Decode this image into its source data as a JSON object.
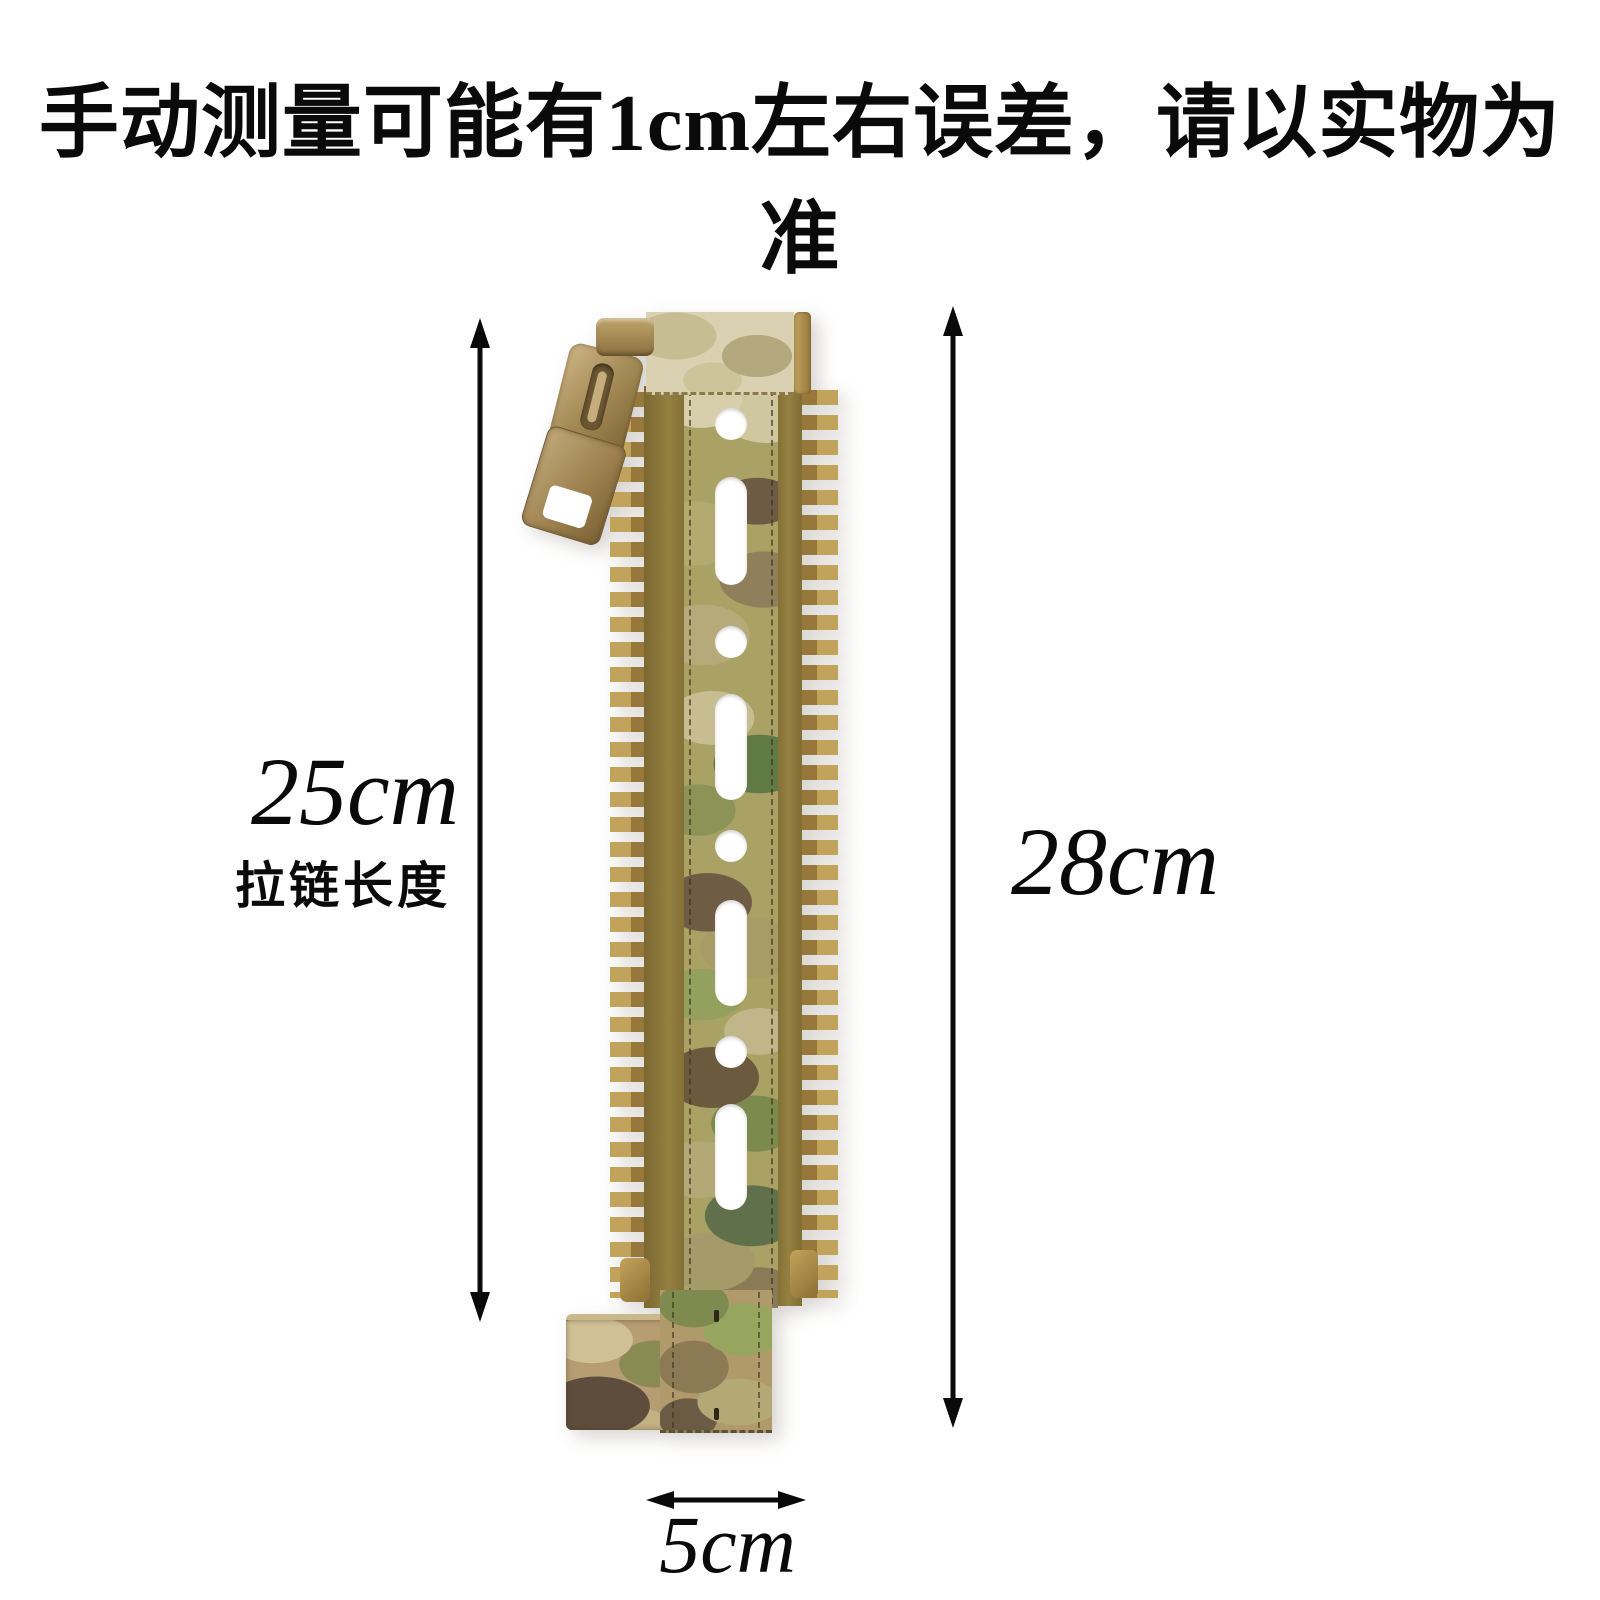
{
  "disclaimer": {
    "text": "手动测量可能有1cm左右误差，请以实物为准"
  },
  "dimensions": {
    "zipper_length": {
      "value": "25cm",
      "label": "拉链长度"
    },
    "total_length": {
      "value": "28cm"
    },
    "width": {
      "value": "5cm"
    }
  },
  "product": {
    "colors": {
      "zipper_teeth": "#b3924a",
      "zipper_tape": "#8d783c",
      "slider": "#a88c5a",
      "camo_sand": "#d7cfab",
      "camo_yellow_green": "#a9a264",
      "camo_olive_green": "#5f7a44",
      "camo_brown": "#6d5b45",
      "camo_dark_brown": "#57462f",
      "arrow": "#000000",
      "background": "#ffffff"
    }
  }
}
